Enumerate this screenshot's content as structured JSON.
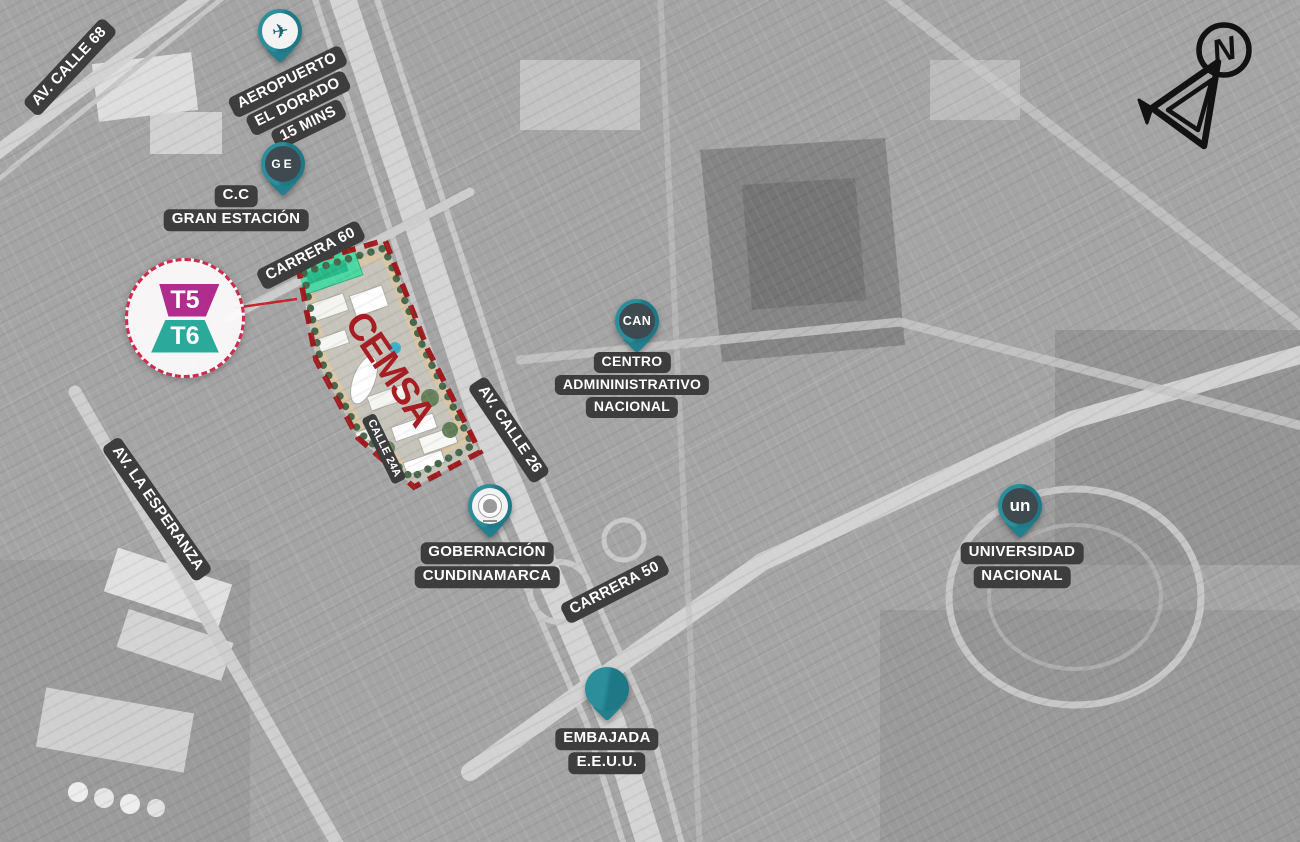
{
  "compass": {
    "letter": "N"
  },
  "streets": {
    "av_calle_68": "AV. CALLE 68",
    "carrera_60": "CARRERA 60",
    "av_calle_26": "AV. CALLE 26",
    "calle_24a": "CALLE 24A",
    "av_la_esperanza": "AV. LA ESPERANZA",
    "carrera_50": "CARRERA 50"
  },
  "site": {
    "name": "CEMSA",
    "badge_top": "T5",
    "badge_bottom": "T6"
  },
  "pins": {
    "aeropuerto": {
      "icon": "airplane-icon",
      "lines": [
        "AEROPUERTO",
        "EL DORADO",
        "15 MINS"
      ]
    },
    "gran_estacion": {
      "icon": "ge-logo-icon",
      "logo_text": "GE",
      "lines": [
        "C.C",
        "GRAN ESTACIÓN"
      ]
    },
    "can": {
      "icon": "can-logo-icon",
      "logo_text": "CAN",
      "lines": [
        "CENTRO",
        "ADMININISTRATIVO",
        "NACIONAL"
      ]
    },
    "gobernacion": {
      "icon": "crest-icon",
      "lines": [
        "GOBERNACIÓN",
        "CUNDINAMARCA"
      ]
    },
    "embajada": {
      "icon": "us-flag-icon",
      "lines": [
        "EMBAJADA",
        "E.E.U.U."
      ]
    },
    "universidad": {
      "icon": "un-logo-icon",
      "logo_text": "un",
      "lines": [
        "UNIVERSIDAD",
        "NACIONAL"
      ]
    }
  },
  "icons": {
    "airplane": "✈"
  },
  "colors": {
    "pin_teal": "#27808e",
    "chip_bg": "#3d3d3d",
    "site_outline_red": "#9e1b1e",
    "cemsa_red": "#a61e23",
    "badge_border_red": "#d02a4e",
    "t5_magenta": "#b12d8d",
    "t6_teal": "#2ba99b",
    "site_green_building": "#4cd8a2"
  }
}
